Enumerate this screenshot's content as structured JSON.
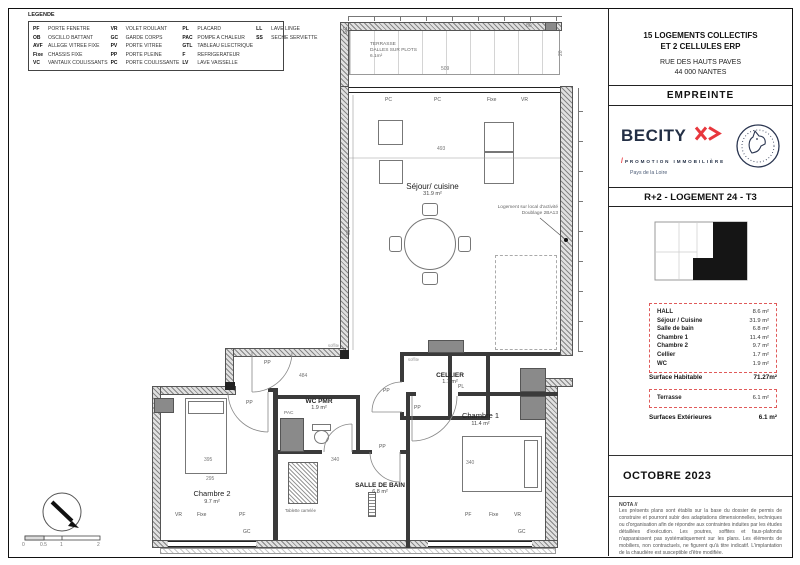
{
  "legend": {
    "title": "LEGENDE",
    "columns": [
      {
        "items": [
          {
            "abbr": "PF",
            "label": "PORTE FENETRE"
          },
          {
            "abbr": "OB",
            "label": "OSCILLO BATTANT"
          },
          {
            "abbr": "AVF",
            "label": "ALLEGE VITREE FIXE"
          },
          {
            "abbr": "Fixe",
            "label": "CHASSIS FIXE"
          },
          {
            "abbr": "VC",
            "label": "VANTAUX COULISSANTS"
          }
        ]
      },
      {
        "items": [
          {
            "abbr": "VR",
            "label": "VOLET ROULANT"
          },
          {
            "abbr": "GC",
            "label": "GARDE CORPS"
          },
          {
            "abbr": "PV",
            "label": "PORTE VITREE"
          },
          {
            "abbr": "PP",
            "label": "PORTE PLEINE"
          },
          {
            "abbr": "PC",
            "label": "PORTE COULISSANTE"
          }
        ]
      },
      {
        "items": [
          {
            "abbr": "PL",
            "label": "PLACARD"
          },
          {
            "abbr": "PAC",
            "label": "POMPE A CHALEUR"
          },
          {
            "abbr": "GTL",
            "label": "TABLEAU ELECTRIQUE"
          },
          {
            "abbr": "F",
            "label": "REFRIGERATEUR"
          },
          {
            "abbr": "LV",
            "label": "LAVE VAISSELLE"
          }
        ]
      },
      {
        "items": [
          {
            "abbr": "LL",
            "label": "LAVE LINGE"
          },
          {
            "abbr": "SS",
            "label": "SECHE SERVIETTE"
          }
        ]
      }
    ]
  },
  "title_block": {
    "project": {
      "line1": "15 LOGEMENTS COLLECTIFS",
      "line2": "ET 2 CELLULES ERP",
      "address1": "RUE DES HAUTS PAVES",
      "address2": "44 000 NANTES"
    },
    "architect": "EMPREINTE",
    "developer": {
      "name": "BECITY",
      "tagline": "PROMOTION IMMOBILIÈRE",
      "region": "Pays de la Loire"
    },
    "drawing_title": "R+2 - LOGEMENT 24 - T3",
    "areas": {
      "rows": [
        {
          "label": "HALL",
          "value": "8.6 m²"
        },
        {
          "label": "Séjour / Cuisine",
          "value": "31.9 m²"
        },
        {
          "label": "Salle de bain",
          "value": "6.8 m²"
        },
        {
          "label": "Chambre 1",
          "value": "11.4 m²"
        },
        {
          "label": "Chambre 2",
          "value": "9.7 m²"
        },
        {
          "label": "Cellier",
          "value": "1.7 m²"
        },
        {
          "label": "WC",
          "value": "1.9 m²"
        }
      ],
      "habitable_label": "Surface Habitable",
      "habitable_value": "71.27m²",
      "terrasse_label": "Terrasse",
      "terrasse_value": "6.1 m²",
      "exterieures_label": "Surfaces Extérieures",
      "exterieures_value": "6.1 m²"
    },
    "date": "OCTOBRE 2023",
    "nota_title": "NOTA //",
    "nota_text": "Les présents plans sont établis sur la base du dossier de permis de construire et pourront subir des adaptations dimensionnelles, techniques ou d'organisation afin de répondre aux contraintes induites par les études détaillées d'exécution. Les poutres, soffites et faux-plafonds n'apparaissent pas systématiquement sur les plans. Les éléments de mobiliers, non contractuels, ne figurent qu'à titre indicatif. L'implantation de la chaudière est susceptible d'être modifiée."
  },
  "plan": {
    "rooms": {
      "terrasse": {
        "l1": "TERRASSE",
        "l2": "DALLES SUR PLOTS",
        "area": "6.1m²"
      },
      "sejour": {
        "name": "Séjour/ cuisine",
        "area": "31.9 m²"
      },
      "cellier": {
        "name": "CELLIER",
        "area": "1.7 m²"
      },
      "wc": {
        "name": "WC PMR",
        "area": "1.9 m²"
      },
      "ch1": {
        "name": "Chambre 1",
        "area": "11.4 m²"
      },
      "ch2": {
        "name": "Chambre 2",
        "area": "9.7 m²"
      },
      "sdb": {
        "name": "SALLE DE BAIN",
        "area": "6.8 m²"
      }
    },
    "annotation": {
      "l1": "Logement sur local d'activité",
      "l2": "Doublage 2BA13"
    },
    "notes": {
      "tablette": "Tablette carrelée",
      "pac": "PAC",
      "soffite1": "soffite",
      "soffite2": "soffite"
    },
    "openings": {
      "pc1": "PC",
      "pc2": "PC",
      "fixe_top": "Fixe",
      "vr_top": "VR",
      "gc_terr": "GC",
      "pp_entry": "PP",
      "pp_ch2": "PP",
      "pp_cellier": "PP",
      "pp_ch1": "PP",
      "pp_sdb": "PP",
      "pl": "PL",
      "vr_b2": "VR",
      "fixe_b2": "Fixe",
      "pf_b2": "PF",
      "gc_b2": "GC",
      "pf_b1": "PF",
      "fixe_b1": "Fixe",
      "vr_b1": "VR",
      "gc_b1": "GC"
    },
    "dims": {
      "d509": "509",
      "d493": "493",
      "d594": "594",
      "d484": "484",
      "d340a": "340",
      "d340b": "340",
      "d395": "395",
      "d295": "295",
      "d80": "80",
      "d20": "20"
    },
    "scale": {
      "t0": "0",
      "t05": "0.5",
      "t1": "1",
      "t2": "2"
    }
  }
}
